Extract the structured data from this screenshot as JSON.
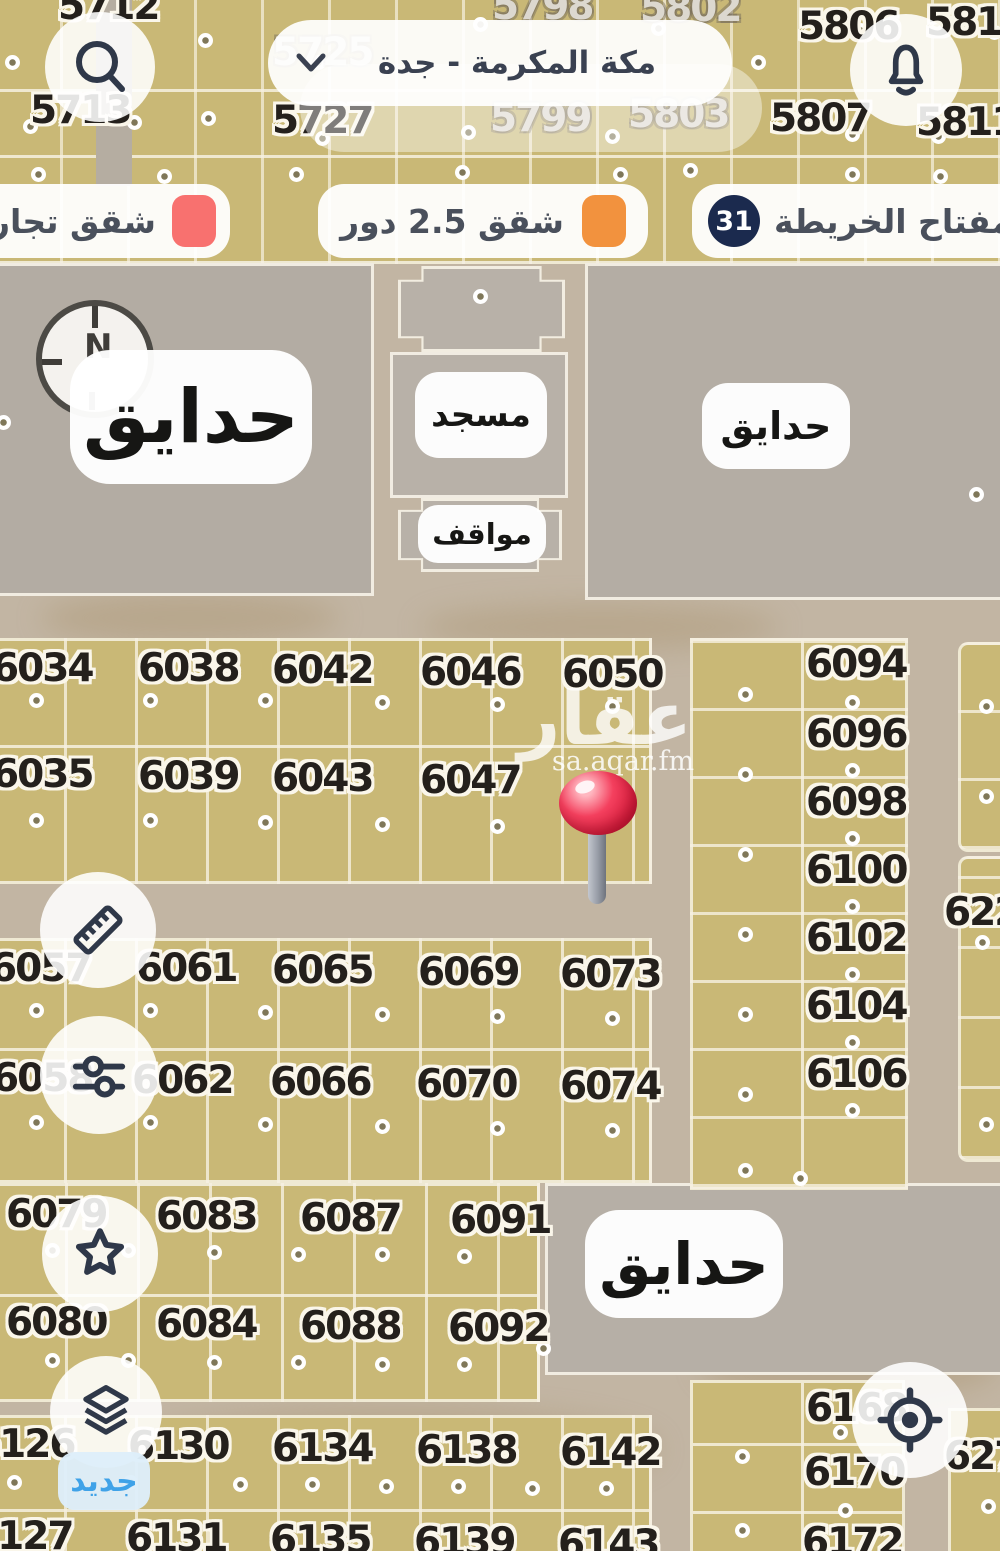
{
  "header": {
    "region": "مكة المكرمة - جدة"
  },
  "legend": {
    "key_label": "مفتاح الخريطة",
    "key_count": "31",
    "item_25_floors": "شقق 2.5 دور",
    "item_commercial": "شقق تجاري",
    "orange": "#F2923E",
    "red": "#F8716F",
    "navy": "#1B2A4E"
  },
  "labels": {
    "park": "حدايق",
    "mosque": "مسجد",
    "parking": "مواقف",
    "new": "جديد",
    "north": "N"
  },
  "watermark": {
    "logo": "عقار",
    "site": "sa.aqar.fm"
  },
  "icons": {
    "search": "magnifier",
    "notifications": "bell",
    "measure": "ruler",
    "filters": "sliders",
    "favorites": "star",
    "layers": "stacked-layers",
    "locate": "crosshair-target",
    "region_chevron": "chevron-down",
    "pin": "red-map-pin",
    "compass": "north-compass"
  },
  "plots": {
    "top": [
      "5712",
      "5798",
      "5802",
      "5806",
      "5810",
      "5713",
      "5725",
      "5727",
      "5799",
      "5803",
      "5807",
      "5811"
    ],
    "block_a": [
      "6034",
      "6038",
      "6042",
      "6046",
      "6050",
      "6035",
      "6039",
      "6043",
      "6047"
    ],
    "block_b": [
      "6057",
      "6061",
      "6065",
      "6069",
      "6073",
      "6058",
      "6062",
      "6066",
      "6070",
      "6074"
    ],
    "block_c": [
      "6079",
      "6083",
      "6087",
      "6091",
      "6080",
      "6084",
      "6088",
      "6092"
    ],
    "block_d": [
      "6126",
      "6130",
      "6134",
      "6138",
      "6142",
      "6127",
      "6131",
      "6135",
      "6139",
      "6143"
    ],
    "right_column": [
      "6094",
      "6096",
      "6098",
      "6100",
      "6102",
      "6104",
      "6106"
    ],
    "far_right": [
      "622",
      "627"
    ],
    "bottom_right": [
      "6168",
      "6170",
      "6172"
    ]
  }
}
